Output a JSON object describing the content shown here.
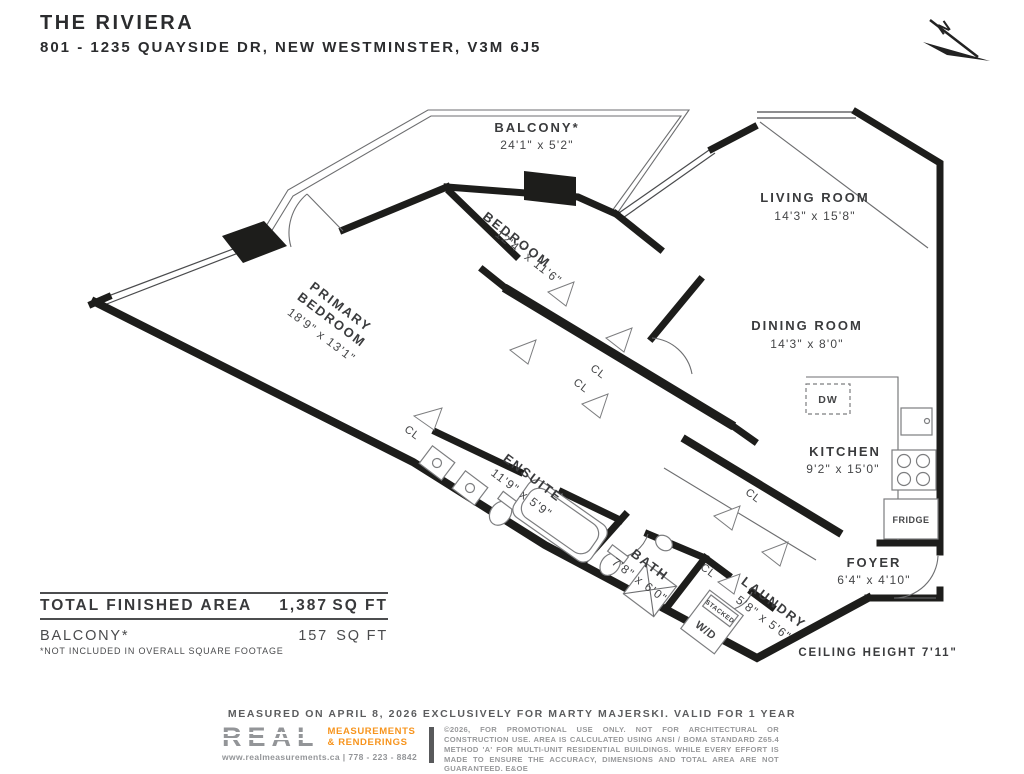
{
  "header": {
    "title": "THE RIVIERA",
    "address": "801 - 1235 QUAYSIDE DR, NEW WESTMINSTER, V3M 6J5"
  },
  "north_indicator": {
    "label": "N"
  },
  "rooms": {
    "balcony": {
      "name": "BALCONY*",
      "dims": "24'1\" x 5'2\""
    },
    "living_room": {
      "name": "LIVING ROOM",
      "dims": "14'3\" x 15'8\""
    },
    "bedroom": {
      "name": "BEDROOM",
      "dims": "12'4\" x 11'6\""
    },
    "primary_bedroom": {
      "name_line1": "PRIMARY",
      "name_line2": "BEDROOM",
      "dims": "18'9\" x 13'1\""
    },
    "dining_room": {
      "name": "DINING ROOM",
      "dims": "14'3\" x 8'0\""
    },
    "kitchen": {
      "name": "KITCHEN",
      "dims": "9'2\" x 15'0\""
    },
    "ensuite": {
      "name": "ENSUITE",
      "dims": "11'9\" x 5'9\""
    },
    "bath": {
      "name": "BATH",
      "dims": "7'8\" x 6'0\""
    },
    "laundry": {
      "name": "LAUNDRY",
      "dims": "5'8\" x 5'6\""
    },
    "foyer": {
      "name": "FOYER",
      "dims": "6'4\" x 4'10\""
    }
  },
  "fixtures": {
    "dishwasher": "DW",
    "fridge": "FRIDGE",
    "washer_dryer_line1": "STACKED",
    "washer_dryer_line2": "W/D",
    "closet": "CL"
  },
  "notes": {
    "ceiling_height": "CEILING HEIGHT 7'11\""
  },
  "area_table": {
    "rows": [
      {
        "label": "TOTAL FINISHED AREA",
        "value": "1,387",
        "unit": "SQ FT"
      },
      {
        "label": "BALCONY*",
        "value": "157",
        "unit": "SQ FT"
      }
    ],
    "footnote": "*NOT INCLUDED IN OVERALL SQUARE FOOTAGE"
  },
  "footer": {
    "measured_line": "MEASURED ON APRIL 8, 2026 EXCLUSIVELY FOR MARTY MAJERSKI. VALID FOR 1 YEAR",
    "logo": {
      "name": "REAL",
      "tagline_line1": "MEASUREMENTS",
      "tagline_line2": "& RENDERINGS",
      "contact": "www.realmeasurements.ca | 778 - 223 - 8842"
    },
    "disclaimer": "©2026, FOR PROMOTIONAL USE ONLY. NOT FOR ARCHITECTURAL OR CONSTRUCTION USE. AREA IS CALCULATED USING ANSI / BOMA STANDARD Z65.4 METHOD 'A' FOR MULTI-UNIT RESIDENTIAL BUILDINGS. WHILE EVERY EFFORT IS MADE TO ENSURE THE ACCURACY, DIMENSIONS AND TOTAL AREA ARE NOT GUARANTEED. E&OE"
  },
  "colors": {
    "ink": "#231f20",
    "wall": "#1d1d1b",
    "accent_orange": "#f7941d",
    "gray": "#808285"
  }
}
